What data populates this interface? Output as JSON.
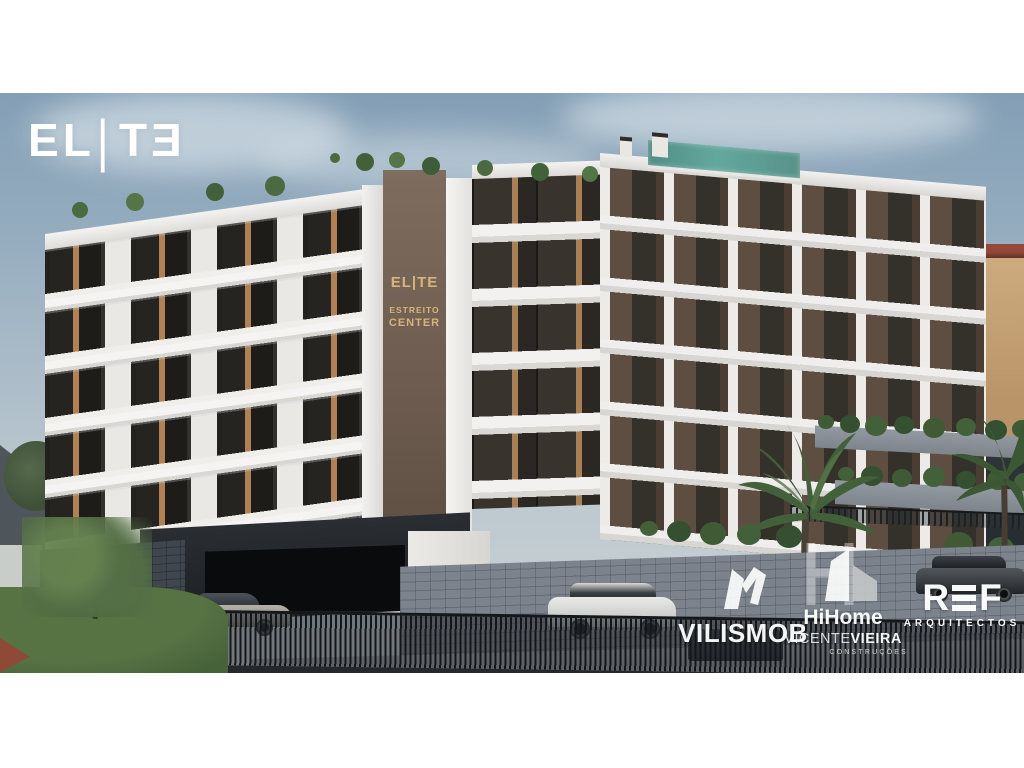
{
  "branding": {
    "logo_glyphs": [
      "E",
      "L",
      "|",
      "T",
      "E"
    ]
  },
  "building_sign": {
    "line1": "EL|TE",
    "line2": "ESTREITO",
    "line3": "CENTER"
  },
  "footer_logos": {
    "vilismob": {
      "name": "VILISMOB"
    },
    "hihome": {
      "brand": "HiHome",
      "name_a": "VICENTE",
      "name_b": "VIEIRA",
      "sub": "CONSTRUÇÕES"
    },
    "ref": {
      "r": "R",
      "f": "F",
      "sub": "ARQUITECTOS"
    }
  },
  "icons": {
    "vilismob_mark": "vilismob-ribbon-monogram",
    "hihome_mark": "h-outline-with-house",
    "ref_e_mark": "three-horizontal-bars"
  },
  "palette": {
    "sky_top": "#849fb6",
    "sky_bottom": "#ccd3d6",
    "facade_white": "#f2f1ef",
    "facade_brown": "#5e4e41",
    "sign_panel_brown": "#6e5c50",
    "sign_gold": "#d8b47d",
    "window_glass": "#34302a",
    "window_warm_light": "#b08155",
    "pool_teal": "#57988f",
    "stone_wall": "#7c838c",
    "fence_dark": "#24282c",
    "grass_green": "#4b683b",
    "background_house_tan": "#c9a87c",
    "roof_red": "#96493a",
    "logo_white": "#ffffff"
  }
}
